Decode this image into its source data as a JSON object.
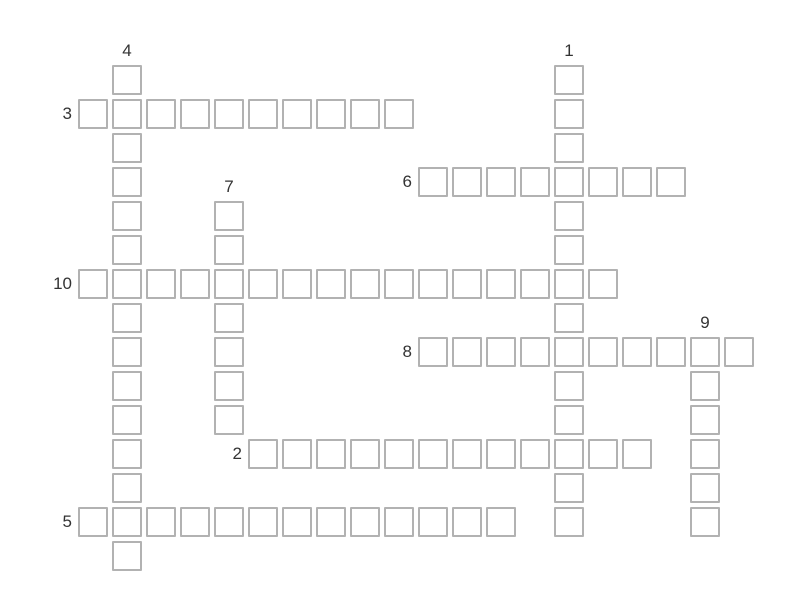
{
  "page": {
    "background": "#ffffff",
    "description": "Empty crossword puzzle grid with numbered clue positions"
  },
  "grid": {
    "origin_x": 78,
    "origin_y": 65,
    "pitch": 34,
    "cell_size": 30,
    "cell_fill": "#ffffff",
    "cell_border_color": "#b2b2b2",
    "label_color": "#333333",
    "cell_value": ""
  },
  "words": [
    {
      "number": "1",
      "orientation": "down",
      "row": 0,
      "col": 14,
      "length": 14
    },
    {
      "number": "2",
      "orientation": "across",
      "row": 11,
      "col": 5,
      "length": 12
    },
    {
      "number": "3",
      "orientation": "across",
      "row": 1,
      "col": 0,
      "length": 10
    },
    {
      "number": "4",
      "orientation": "down",
      "row": 0,
      "col": 1,
      "length": 15
    },
    {
      "number": "5",
      "orientation": "across",
      "row": 13,
      "col": 0,
      "length": 13
    },
    {
      "number": "6",
      "orientation": "across",
      "row": 3,
      "col": 10,
      "length": 8
    },
    {
      "number": "7",
      "orientation": "down",
      "row": 4,
      "col": 4,
      "length": 7
    },
    {
      "number": "8",
      "orientation": "across",
      "row": 8,
      "col": 10,
      "length": 10
    },
    {
      "number": "9",
      "orientation": "down",
      "row": 8,
      "col": 18,
      "length": 6
    },
    {
      "number": "10",
      "orientation": "across",
      "row": 6,
      "col": 0,
      "length": 16
    }
  ]
}
